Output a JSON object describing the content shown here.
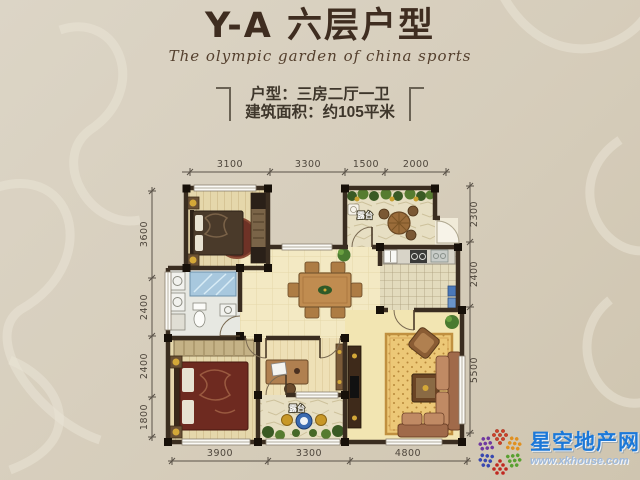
{
  "header": {
    "title": "Y-A 六层户型",
    "subtitle": "The olympic garden of china sports",
    "unit_info": "户型：三房二厅一卫",
    "area_info": "建筑面积：约105平米"
  },
  "dimensions": {
    "top": [
      "3100",
      "3300",
      "1500",
      "2000"
    ],
    "left": [
      "3600",
      "2400",
      "2400",
      "1800"
    ],
    "right": [
      "2300",
      "2400",
      "5500"
    ],
    "bottom": [
      "3900",
      "3300",
      "4800"
    ]
  },
  "rooms": {
    "terrace_top_label": "露台",
    "terrace_bottom_label": "露台"
  },
  "watermark": {
    "site_name": "星空地产网",
    "site_url": "www.xkhouse.com"
  },
  "colors": {
    "brand_blue": "#1b78d8",
    "title_brown": "#3f2d20",
    "wall_dark": "#3a2d20",
    "background_beige": "#d6cdbb"
  }
}
